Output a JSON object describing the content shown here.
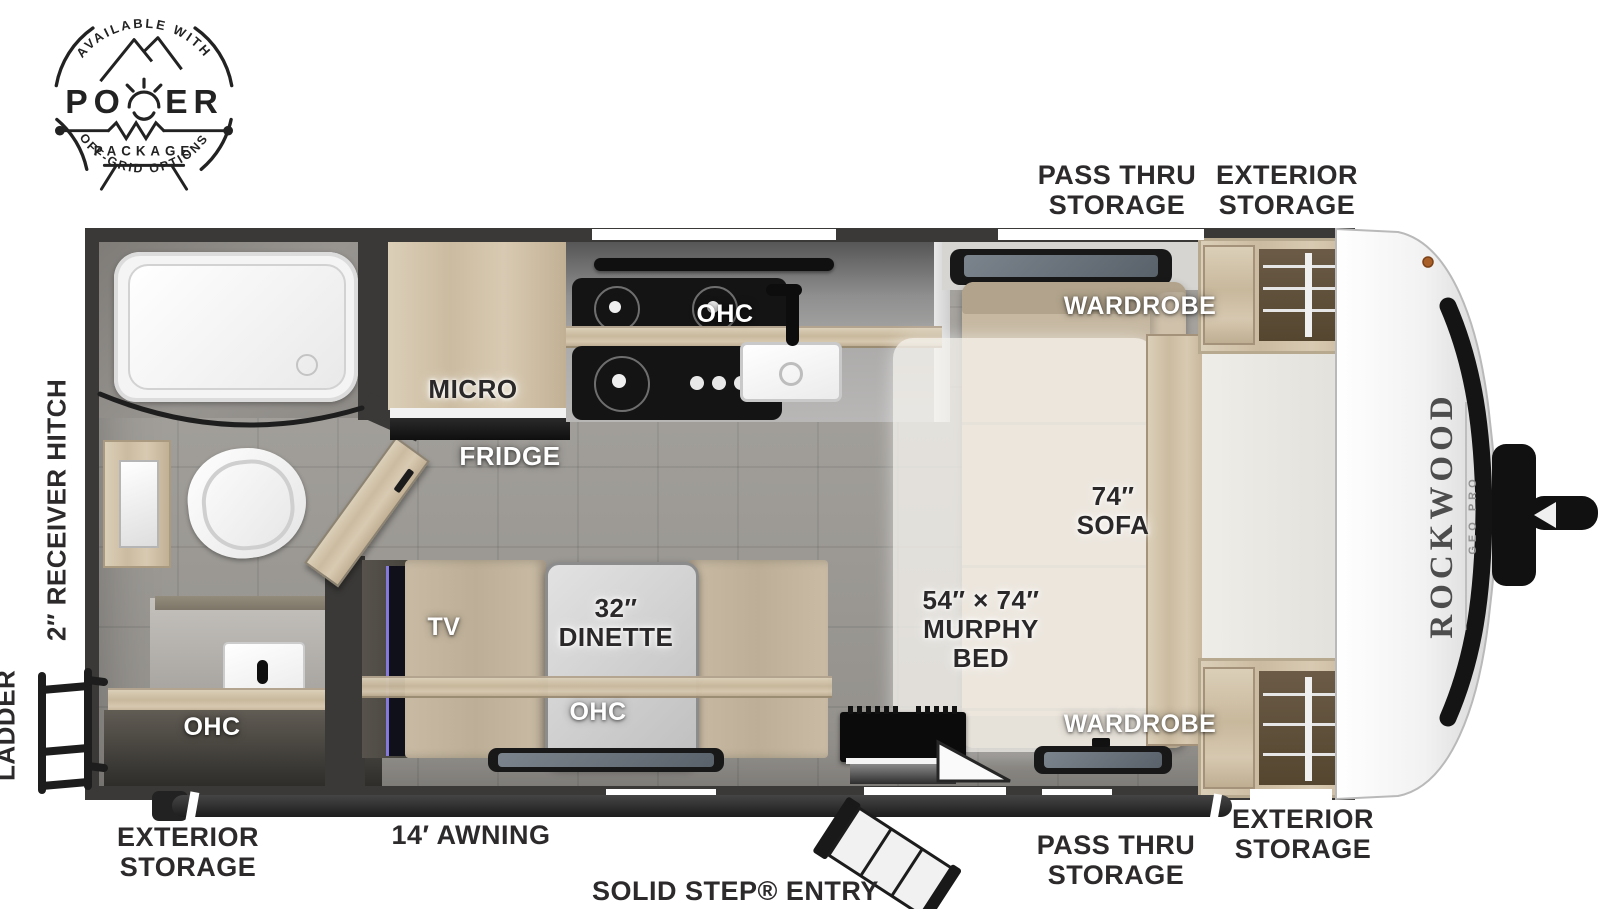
{
  "badge": {
    "arc_top": "AVAILABLE WITH",
    "power": "POWER",
    "package": "PACKAGE",
    "arc_bottom": "OFF-GRID OPTIONS"
  },
  "branding": {
    "make": "ROCKWOOD",
    "model": "GEO PRO"
  },
  "exterior": {
    "pass_thru_top": "PASS THRU STORAGE",
    "exterior_top": "EXTERIOR STORAGE",
    "receiver_hitch": "2″ RECEIVER HITCH",
    "ladder": "LADDER",
    "exterior_bottom_left": "EXTERIOR STORAGE",
    "awning": "14′ AWNING",
    "entry": "SOLID STEP® ENTRY",
    "pass_thru_bottom": "PASS THRU STORAGE",
    "exterior_bottom_right": "EXTERIOR STORAGE"
  },
  "interior": {
    "ohc_kitchen": "OHC",
    "micro": "MICRO",
    "fridge": "FRIDGE",
    "wardrobe_top": "WARDROBE",
    "sofa": "74″ SOFA",
    "murphy_bed": "54″ × 74″ MURPHY BED",
    "wardrobe_bottom": "WARDROBE",
    "tv": "TV",
    "dinette": "32″ DINETTE",
    "ohc_dinette": "OHC",
    "ohc_bath": "OHC"
  },
  "colors": {
    "wall": "#3a3937",
    "label_text": "#2d2a2b",
    "wood": "#d3c5ab",
    "fabric": "#c1b39c",
    "floor": "#a3a09b"
  }
}
